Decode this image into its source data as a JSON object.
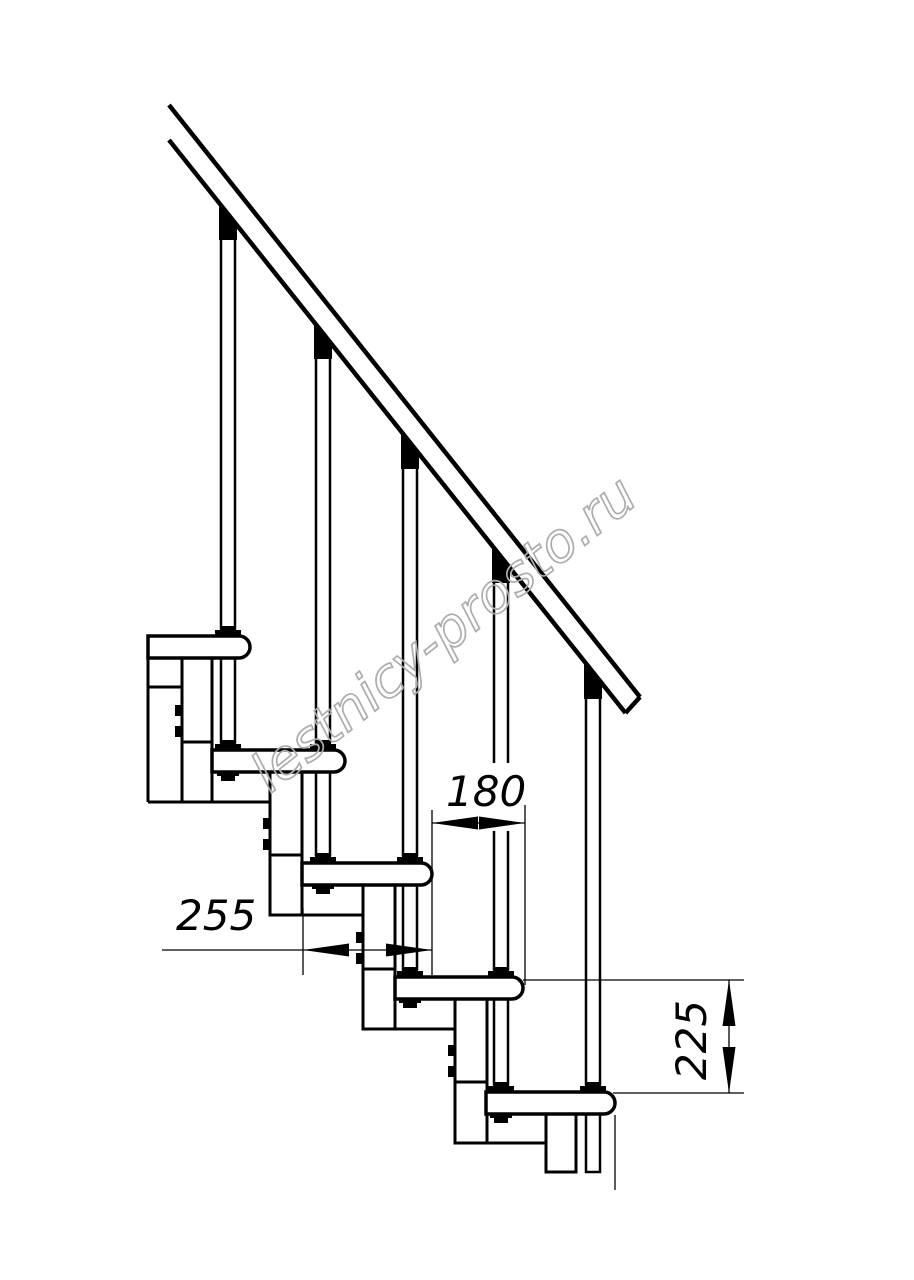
{
  "title": "Modular staircase side view technical drawing",
  "background": "#ffffff",
  "line_color": "#000000",
  "watermark": {
    "text": "lestnicy-prosto.ru",
    "color": "#adadad",
    "angle_deg": -38.3
  },
  "dimensions": [
    {
      "id": "step-going",
      "label": "255",
      "orientation": "horizontal"
    },
    {
      "id": "baluster-offset",
      "label": "180",
      "orientation": "horizontal"
    },
    {
      "id": "step-rise",
      "label": "225",
      "orientation": "vertical"
    }
  ],
  "drawing": {
    "canvas": [
      914,
      1280
    ],
    "rail": {
      "upper": [
        169,
        105,
        640,
        697
      ],
      "lower": [
        169,
        140,
        625.5,
        713
      ],
      "end_cap": [
        640,
        697,
        625.5,
        713
      ],
      "stroke": 4.5
    },
    "treads": [
      {
        "x": 148,
        "e": 250,
        "y": 636
      },
      {
        "x": 212,
        "e": 345,
        "y": 750
      },
      {
        "x": 302,
        "e": 432,
        "y": 863
      },
      {
        "x": 395,
        "e": 523,
        "y": 977
      },
      {
        "x": 486,
        "e": 615,
        "y": 1092
      }
    ],
    "tread_thickness": 22,
    "tread_radius": 11,
    "columns": [
      {
        "x": 182,
        "w": 30,
        "y1": 657,
        "y2": 802,
        "joint": 742
      },
      {
        "x": 270,
        "w": 32,
        "y1": 772,
        "y2": 915,
        "joint": 855
      },
      {
        "x": 363,
        "w": 32,
        "y1": 885,
        "y2": 1029,
        "joint": 969
      },
      {
        "x": 455,
        "w": 32,
        "y1": 999,
        "y2": 1143,
        "joint": 1082
      },
      {
        "x": 546,
        "w": 30,
        "y1": 1114,
        "y2": 1172,
        "joint": null
      }
    ],
    "bottom_lines": [
      [
        148,
        182,
        687
      ],
      [
        148,
        270,
        802
      ],
      [
        270,
        363,
        915
      ],
      [
        363,
        455,
        1029
      ],
      [
        455,
        546,
        1143
      ]
    ],
    "extra_lines": [
      {
        "pts": [
          148,
          636,
          148,
          802
        ],
        "w": 3
      },
      {
        "pts": [
          615,
          1115,
          615,
          1190
        ],
        "w": 1.3
      }
    ],
    "balusters": [
      {
        "cx": 228,
        "cap": {
          "yl": 202.8,
          "yr": 225.4,
          "yb": 240
        },
        "shaft": [
          238,
          628
        ],
        "foot1": 636,
        "lower": [
          658,
          742
        ],
        "foot2": 750,
        "nut": 772
      },
      {
        "cx": 323,
        "cap": {
          "yl": 322.2,
          "yr": 344.8,
          "yb": 359
        },
        "shaft": [
          357,
          742
        ],
        "foot1": 750,
        "lower": [
          772,
          855
        ],
        "foot2": 863,
        "nut": 885
      },
      {
        "cx": 410,
        "cap": {
          "yl": 431.6,
          "yr": 454.2,
          "yb": 469
        },
        "shaft": [
          467,
          855
        ],
        "foot1": 863,
        "lower": [
          885,
          969
        ],
        "foot2": 977,
        "nut": 999
      },
      {
        "cx": 501,
        "cap": {
          "yl": 546.0,
          "yr": 568.6,
          "yb": 583
        },
        "shaft": [
          581,
          969
        ],
        "foot1": 977,
        "lower": [
          999,
          1084
        ],
        "foot2": 1092,
        "nut": 1114
      },
      {
        "cx": 593,
        "cap": {
          "yl": 661.6,
          "yr": 684.2,
          "yb": 699
        },
        "shaft": [
          697,
          1084
        ],
        "foot1": 1092,
        "lower": [
          1114,
          1172
        ],
        "foot2": null,
        "nut": null
      }
    ],
    "dims": {
      "d255": {
        "ext": [
          [
            303,
            908,
            303,
            975
          ]
        ],
        "line": [
          162,
          950,
          432,
          950
        ],
        "arrows": [
          {
            "tip": [
              303,
              950
            ],
            "dir": "left"
          },
          {
            "tip": [
              432,
              950
            ],
            "dir": "right"
          }
        ]
      },
      "d180": {
        "halo": [
          441,
          763,
          78,
          68
        ],
        "ext": [
          [
            432,
            810,
            432,
            975
          ],
          [
            525,
            805,
            525,
            985
          ]
        ],
        "line": [
          432,
          823,
          525,
          823
        ],
        "arrows": [
          {
            "tip": [
              432,
              823
            ],
            "dir": "left"
          },
          {
            "tip": [
              525,
              823
            ],
            "dir": "right"
          }
        ]
      },
      "d225": {
        "ext": [
          [
            523,
            980,
            744,
            980
          ],
          [
            613,
            1093,
            744,
            1093
          ]
        ],
        "line": [
          729,
          980,
          729,
          1093
        ],
        "arrows": [
          {
            "tip": [
              729,
              980
            ],
            "dir": "up"
          },
          {
            "tip": [
              729,
              1093
            ],
            "dir": "down"
          }
        ]
      },
      "thin_stroke": 1.3,
      "arrow_len": 46,
      "arrow_halfwidth": 6.5
    }
  }
}
